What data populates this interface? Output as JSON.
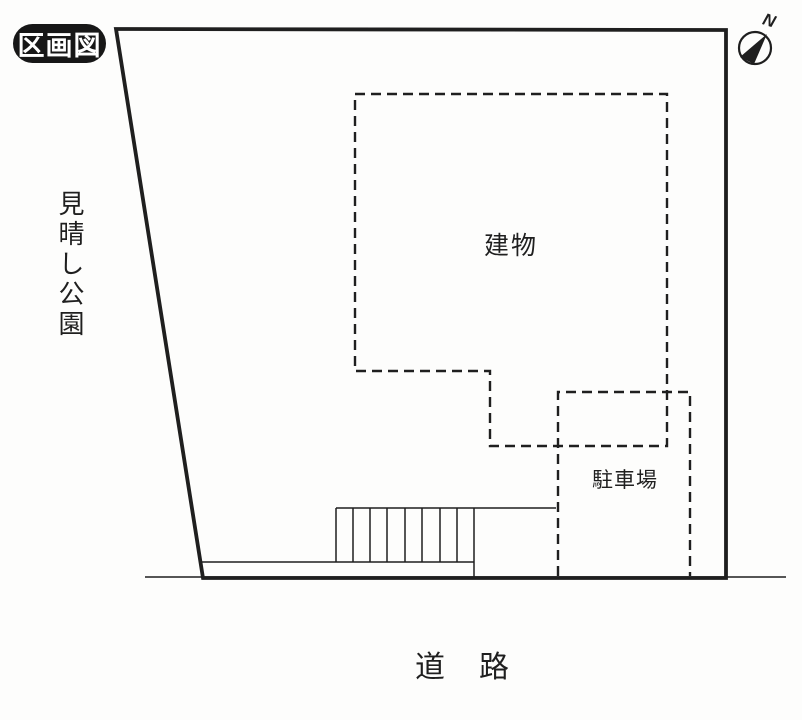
{
  "title_badge": {
    "label": "区画図"
  },
  "labels": {
    "park": "見晴し公園",
    "building": "建物",
    "parking": "駐車場",
    "road": "道　路",
    "compass_north": "N"
  },
  "colors": {
    "ink": "#1f1f1f",
    "paper": "#fdfdfc",
    "badge-bg": "#171717",
    "badge-text": "#ffffff"
  }
}
